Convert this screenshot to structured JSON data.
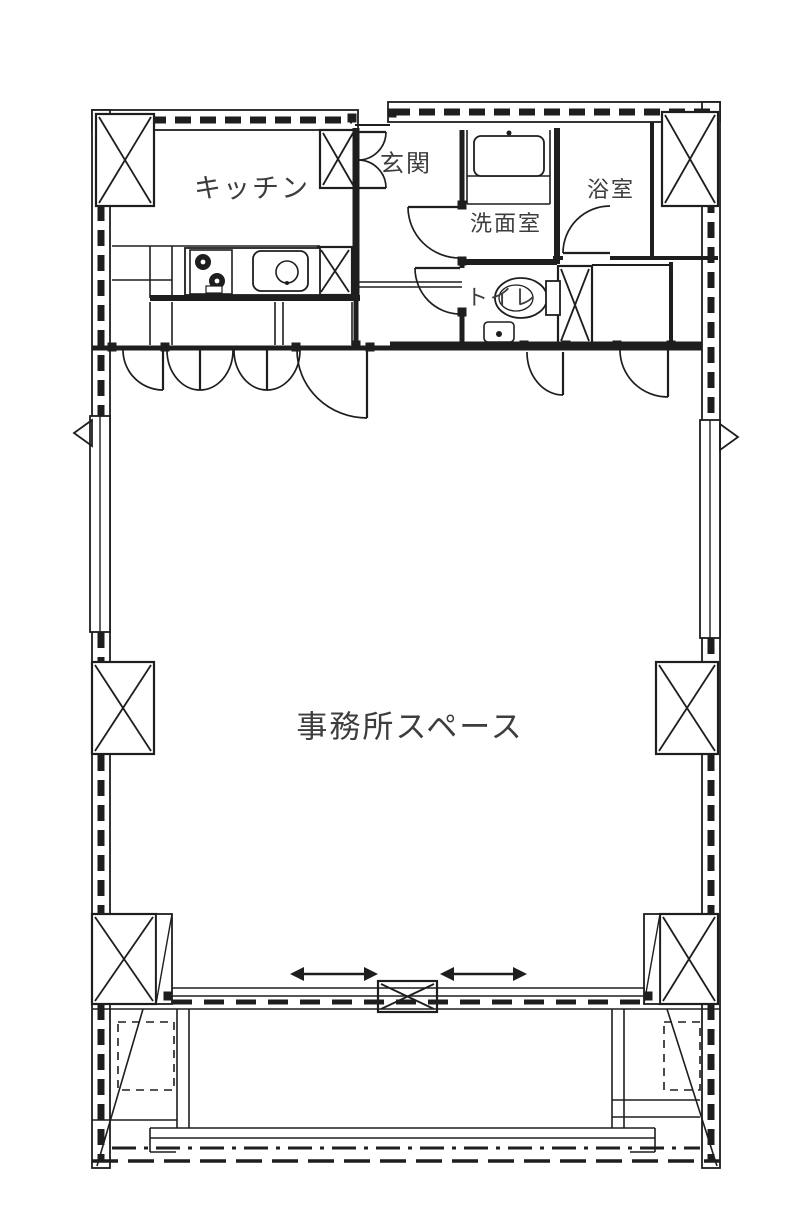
{
  "plan": {
    "type": "floor-plan",
    "background": "#ffffff",
    "line_color": "#1e1e1e",
    "label_color": "#3d3d3d",
    "rooms": [
      {
        "id": "kitchen",
        "label": "キッチン",
        "cx": 252,
        "cy": 186,
        "font": 27
      },
      {
        "id": "entrance",
        "label": "玄関",
        "cx": 406,
        "cy": 161,
        "font": 24
      },
      {
        "id": "washroom",
        "label": "洗面室",
        "cx": 506,
        "cy": 222,
        "font": 22
      },
      {
        "id": "bathroom",
        "label": "浴室",
        "cx": 611,
        "cy": 188,
        "font": 22
      },
      {
        "id": "toilet",
        "label": "トイレ",
        "cx": 502,
        "cy": 296,
        "font": 22
      },
      {
        "id": "office",
        "label": "事務所スペース",
        "cx": 410,
        "cy": 724,
        "font": 31
      }
    ],
    "geometry": {
      "ext_walls": [
        {
          "x": 92,
          "y": 110,
          "w": 266,
          "h": 20
        },
        {
          "x": 388,
          "y": 102,
          "w": 332,
          "h": 20
        },
        {
          "x": 92,
          "y": 110,
          "w": 18,
          "h": 1058
        },
        {
          "x": 702,
          "y": 102,
          "w": 18,
          "h": 1066
        }
      ],
      "wall_dashes": [
        [
          101,
          130,
          101,
          416
        ],
        [
          101,
          632,
          101,
          662
        ],
        [
          101,
          755,
          101,
          914
        ],
        [
          101,
          1004,
          101,
          1162
        ],
        [
          711,
          122,
          711,
          420
        ],
        [
          711,
          638,
          711,
          662
        ],
        [
          711,
          755,
          711,
          914
        ],
        [
          711,
          1004,
          711,
          1162
        ],
        [
          100,
          120,
          352,
          120
        ],
        [
          394,
          112,
          714,
          112
        ]
      ],
      "columns": [
        {
          "x": 96,
          "y": 114,
          "w": 58,
          "h": 92
        },
        {
          "x": 662,
          "y": 112,
          "w": 56,
          "h": 94
        },
        {
          "x": 92,
          "y": 662,
          "w": 62,
          "h": 92
        },
        {
          "x": 656,
          "y": 662,
          "w": 62,
          "h": 92
        },
        {
          "x": 92,
          "y": 914,
          "w": 64,
          "h": 90
        },
        {
          "x": 660,
          "y": 914,
          "w": 58,
          "h": 90
        },
        {
          "x": 378,
          "y": 981,
          "w": 59,
          "h": 31
        },
        {
          "x": 558,
          "y": 266,
          "w": 34,
          "h": 78
        },
        {
          "x": 320,
          "y": 130,
          "w": 36,
          "h": 58
        },
        {
          "x": 318,
          "y": 247,
          "w": 34,
          "h": 48
        }
      ],
      "strips": [
        {
          "x": 156,
          "y": 914,
          "w": 16,
          "h": 90
        },
        {
          "x": 644,
          "y": 914,
          "w": 16,
          "h": 90
        }
      ],
      "solid_walls": [
        [
          356,
          128,
          356,
          300,
          7
        ],
        [
          356,
          298,
          356,
          348,
          5
        ],
        [
          462,
          130,
          462,
          207,
          5
        ],
        [
          462,
          258,
          462,
          268,
          5
        ],
        [
          462,
          314,
          462,
          346,
          5
        ],
        [
          557,
          128,
          557,
          264,
          6
        ],
        [
          460,
          262,
          557,
          262,
          6
        ],
        [
          553,
          258,
          563,
          258,
          4
        ],
        [
          610,
          258,
          718,
          258,
          4
        ],
        [
          652,
          122,
          652,
          258,
          4
        ],
        [
          671,
          262,
          671,
          344,
          4
        ],
        [
          92,
          348,
          390,
          348,
          5
        ],
        [
          390,
          346,
          702,
          346,
          9
        ],
        [
          150,
          298,
          360,
          298,
          6
        ],
        [
          355,
          125,
          390,
          125,
          2
        ],
        [
          592,
          265,
          671,
          265,
          2
        ],
        [
          592,
          266,
          592,
          344,
          2
        ]
      ],
      "thin_lines": [
        [
          112,
          246,
          320,
          246
        ],
        [
          150,
          246,
          150,
          298
        ],
        [
          172,
          246,
          172,
          298
        ],
        [
          112,
          280,
          172,
          280
        ],
        [
          150,
          302,
          150,
          345
        ],
        [
          172,
          302,
          172,
          345
        ],
        [
          275,
          302,
          275,
          345
        ],
        [
          283,
          302,
          283,
          345
        ],
        [
          352,
          302,
          352,
          345
        ],
        [
          358,
          282,
          462,
          282
        ],
        [
          358,
          287,
          462,
          287
        ],
        [
          467,
          130,
          467,
          204
        ],
        [
          550,
          130,
          550,
          204
        ],
        [
          467,
          176,
          550,
          176
        ],
        [
          467,
          204,
          550,
          204
        ],
        [
          177,
          1009,
          177,
          1128
        ],
        [
          189,
          1009,
          189,
          1128
        ],
        [
          612,
          1009,
          612,
          1128
        ],
        [
          624,
          1009,
          624,
          1128
        ],
        [
          150,
          1128,
          655,
          1128
        ],
        [
          150,
          1138,
          655,
          1138
        ],
        [
          150,
          1128,
          150,
          1152
        ],
        [
          655,
          1128,
          655,
          1152
        ],
        [
          150,
          1152,
          176,
          1152
        ],
        [
          630,
          1152,
          655,
          1152
        ],
        [
          92,
          1120,
          177,
          1120
        ],
        [
          612,
          1100,
          700,
          1100
        ],
        [
          612,
          1117,
          700,
          1117
        ],
        [
          143,
          1009,
          97,
          1166
        ],
        [
          667,
          1009,
          717,
          1166
        ],
        [
          172,
          988,
          645,
          988
        ],
        [
          172,
          996,
          645,
          996
        ],
        [
          92,
          1009,
          720,
          1009
        ]
      ],
      "dash_lines": [
        {
          "pts": [
            172,
            1002,
            645,
            1002
          ],
          "w": 5,
          "dash": "20,12"
        },
        {
          "pts": [
            112,
            1148,
            700,
            1148
          ],
          "w": 3,
          "dash": "24,8,4,8"
        },
        {
          "pts": [
            92,
            1161,
            720,
            1161
          ],
          "w": 3.5,
          "dash": "26,10"
        }
      ],
      "dash_rects": [
        {
          "x": 118,
          "y": 1022,
          "w": 56,
          "h": 68
        },
        {
          "x": 664,
          "y": 1022,
          "w": 36,
          "h": 68
        }
      ],
      "doors": [
        {
          "arc": "M123,350 A40,40 0 0 0 163,390",
          "leaf": [
            163,
            350,
            163,
            390
          ]
        },
        {
          "arc": "M167,350 A33,40 0 0 0 200,390",
          "leaf": [
            200,
            350,
            200,
            390
          ]
        },
        {
          "arc": "M233,350 A33,40 0 0 1 200,390",
          "leaf": null
        },
        {
          "arc": "M234,350 A33,40 0 0 0 267,390",
          "leaf": [
            267,
            350,
            267,
            390
          ]
        },
        {
          "arc": "M300,350 A33,40 0 0 1 267,390",
          "leaf": null
        },
        {
          "arc": "M297,350 A70,68 0 0 0 367,418",
          "leaf": [
            367,
            350,
            367,
            418
          ]
        },
        {
          "arc": "M527,352 A36,43 0 0 0 563,395",
          "leaf": [
            563,
            352,
            563,
            395
          ]
        },
        {
          "arc": "M620,350 A48,47 0 0 0 668,397",
          "leaf": [
            668,
            350,
            668,
            397
          ]
        },
        {
          "arc": "M408,207 A52,51 0 0 0 460,258",
          "leaf": [
            408,
            207,
            460,
            207
          ]
        },
        {
          "arc": "M415,268 A45,46 0 0 0 460,314",
          "leaf": [
            415,
            268,
            460,
            268
          ]
        },
        {
          "arc": "M563,253 A47,47 0 0 1 610,206",
          "leaf": [
            563,
            253,
            610,
            253
          ]
        },
        {
          "arc": "M386,132 A28,28 0 0 1 358,160",
          "leaf": [
            358,
            132,
            386,
            132
          ]
        },
        {
          "arc": "M386,188 A28,28 0 0 0 358,160",
          "leaf": [
            358,
            188,
            386,
            188
          ]
        }
      ],
      "arrows": [
        {
          "x1": 290,
          "x2": 378,
          "y": 974
        },
        {
          "x1": 440,
          "x2": 527,
          "y": 974
        }
      ],
      "triangles": [
        [
          [
            92,
            420
          ],
          [
            92,
            446
          ],
          [
            74,
            433
          ]
        ],
        [
          [
            720,
            424
          ],
          [
            720,
            450
          ],
          [
            738,
            437
          ]
        ]
      ],
      "jambs": [
        [
          112,
          347
        ],
        [
          165,
          347
        ],
        [
          296,
          347
        ],
        [
          370,
          347
        ],
        [
          524,
          345
        ],
        [
          566,
          345
        ],
        [
          617,
          345
        ],
        [
          671,
          345
        ],
        [
          462,
          205
        ],
        [
          462,
          261
        ],
        [
          462,
          312
        ],
        [
          352,
          118
        ],
        [
          392,
          113
        ],
        [
          168,
          996
        ],
        [
          648,
          996
        ],
        [
          356,
          345
        ]
      ],
      "fixtures": {
        "counter": {
          "x": 185,
          "y": 248,
          "w": 135,
          "h": 47
        },
        "stove": {
          "x": 190,
          "y": 250,
          "w": 42,
          "h": 44,
          "burners": [
            [
              203,
              262,
              8
            ],
            [
              217,
              281,
              8
            ]
          ],
          "grill": [
            206,
            286,
            16,
            7
          ]
        },
        "sink": {
          "x": 253,
          "y": 251,
          "w": 55,
          "h": 40,
          "r": 8,
          "drain": [
            287,
            272,
            11
          ]
        },
        "wash_pan": {
          "x": 474,
          "y": 136,
          "w": 70,
          "h": 40,
          "r": 7,
          "tap": [
            509,
            133,
            2.5
          ]
        },
        "toilet": {
          "bowl": [
            521,
            298,
            26,
            20
          ],
          "inner": [
            516,
            298,
            17,
            13
          ],
          "tank": [
            546,
            281,
            14,
            34
          ]
        },
        "hand_basin": {
          "x": 484,
          "y": 322,
          "w": 30,
          "h": 20,
          "r": 4,
          "tap": [
            499,
            334,
            3
          ]
        }
      }
    }
  }
}
